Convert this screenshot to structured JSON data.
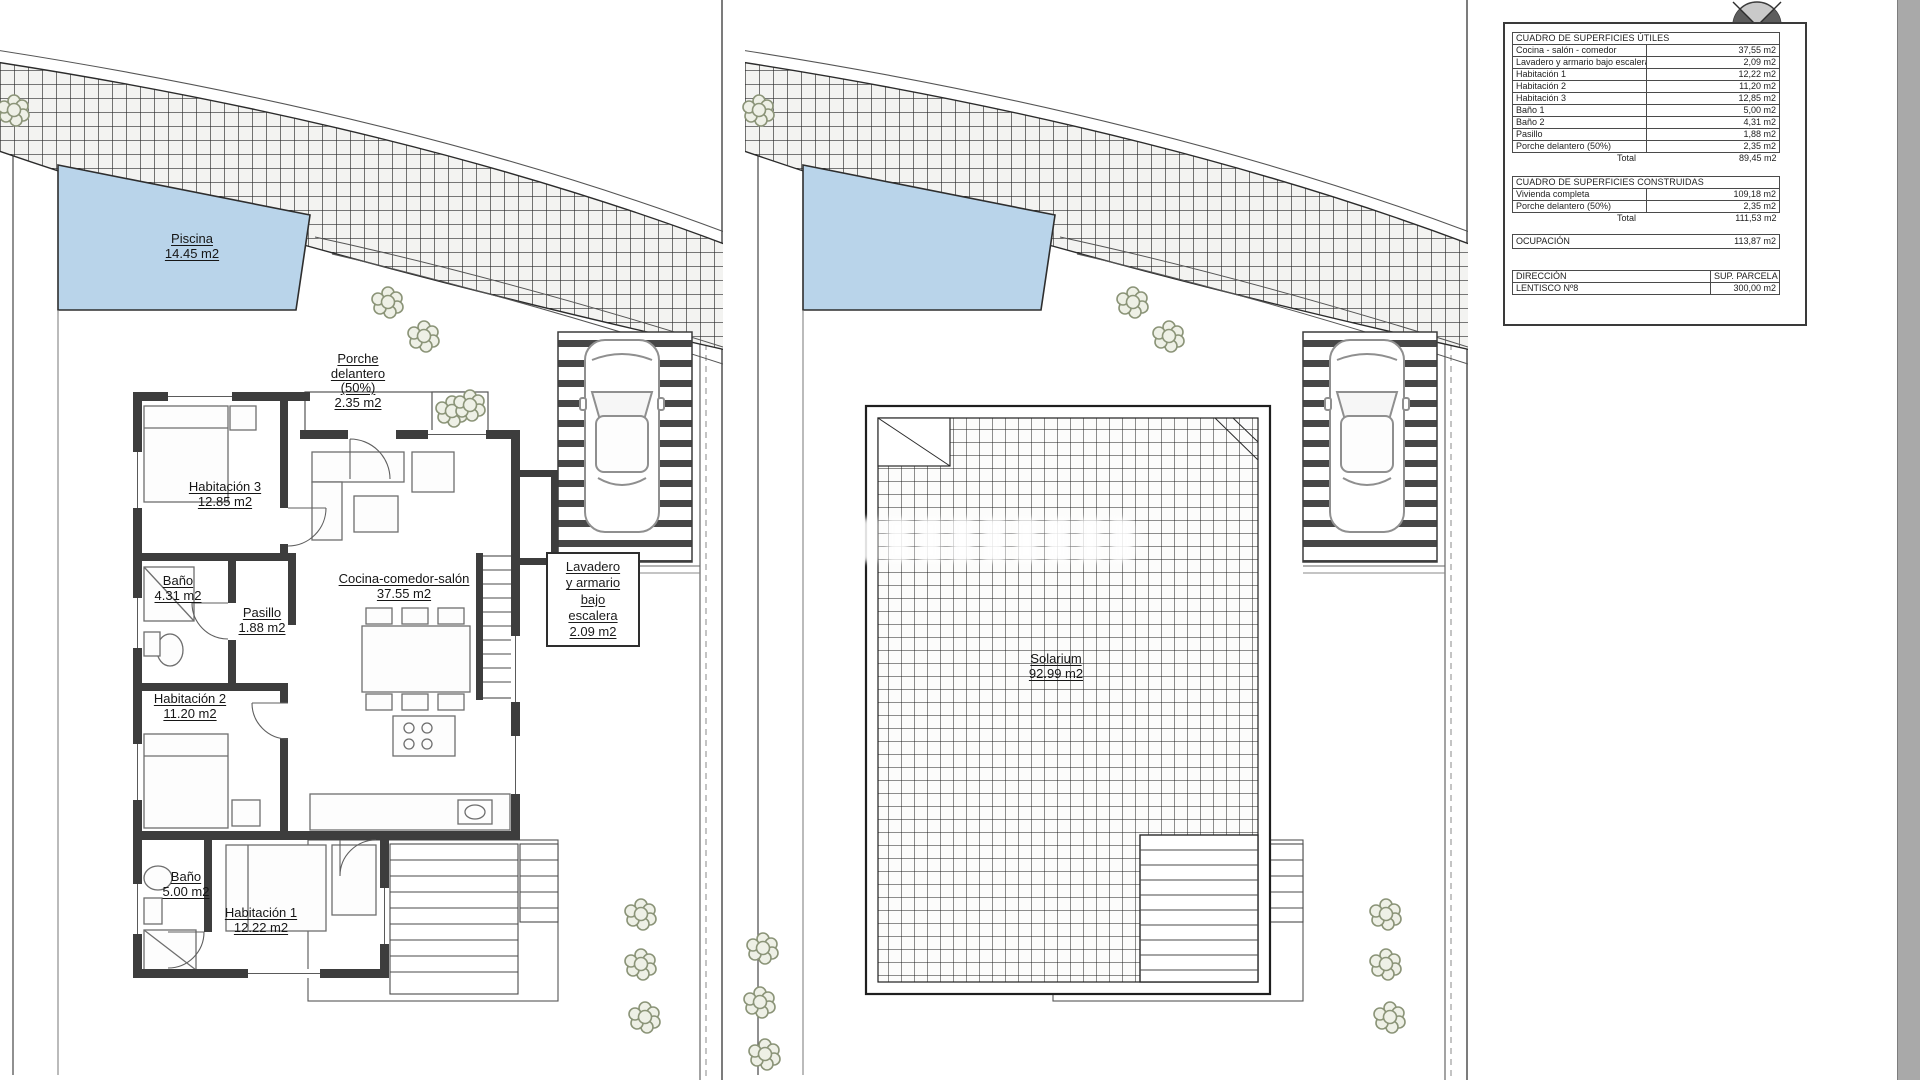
{
  "drawing": {
    "type": "site-and-floor-plan",
    "plans": [
      "Planta baja",
      "Solarium"
    ]
  },
  "labels": {
    "piscina": [
      "Piscina",
      "14.45 m2"
    ],
    "porche": [
      "Porche",
      "delantero",
      "(50%)",
      "2.35 m2"
    ],
    "hab3": [
      "Habitación 3",
      "12.85 m2"
    ],
    "bano1": [
      "Baño",
      "4.31 m2"
    ],
    "pasillo": [
      "Pasillo",
      "1.88 m2"
    ],
    "cocina": [
      "Cocina-comedor-salón",
      "37.55 m2"
    ],
    "hab2": [
      "Habitación 2",
      "11.20 m2"
    ],
    "bano2": [
      "Baño",
      "5.00 m2"
    ],
    "hab1": [
      "Habitación 1",
      "12.22 m2"
    ],
    "lavadero": [
      "Lavadero",
      "y armario",
      "bajo",
      "escalera",
      "2.09 m2"
    ],
    "solarium": [
      "Solarium",
      "92.99 m2"
    ]
  },
  "tables": {
    "utiles": {
      "title": "CUADRO DE SUPERFICIES ÚTILES",
      "rows": [
        [
          "Cocina - salón - comedor",
          "37,55 m2"
        ],
        [
          "Lavadero y armario bajo escalera",
          "2,09 m2"
        ],
        [
          "Habitación 1",
          "12,22 m2"
        ],
        [
          "Habitación 2",
          "11,20 m2"
        ],
        [
          "Habitación 3",
          "12,85 m2"
        ],
        [
          "Baño 1",
          "5,00 m2"
        ],
        [
          "Baño 2",
          "4,31 m2"
        ],
        [
          "Pasillo",
          "1,88 m2"
        ],
        [
          "Porche delantero (50%)",
          "2,35 m2"
        ]
      ],
      "total_label": "Total",
      "total_value": "89,45 m2"
    },
    "construidas": {
      "title": "CUADRO DE SUPERFICIES CONSTRUIDAS",
      "rows": [
        [
          "Vivienda completa",
          "109,18 m2"
        ],
        [
          "Porche delantero (50%)",
          "2,35 m2"
        ]
      ],
      "total_label": "Total",
      "total_value": "111,53 m2"
    },
    "ocupacion": {
      "label": "OCUPACIÓN",
      "value": "113,87 m2"
    },
    "direccion": {
      "header": [
        "DIRECCIÓN",
        "SUP. PARCELA"
      ],
      "row": [
        "LENTISCO Nº8",
        "300,00 m2"
      ]
    }
  },
  "colors": {
    "pool": "#b9d4ea",
    "wall": "#3d3d3d",
    "plant": "#8b9478",
    "line": "#444444"
  }
}
